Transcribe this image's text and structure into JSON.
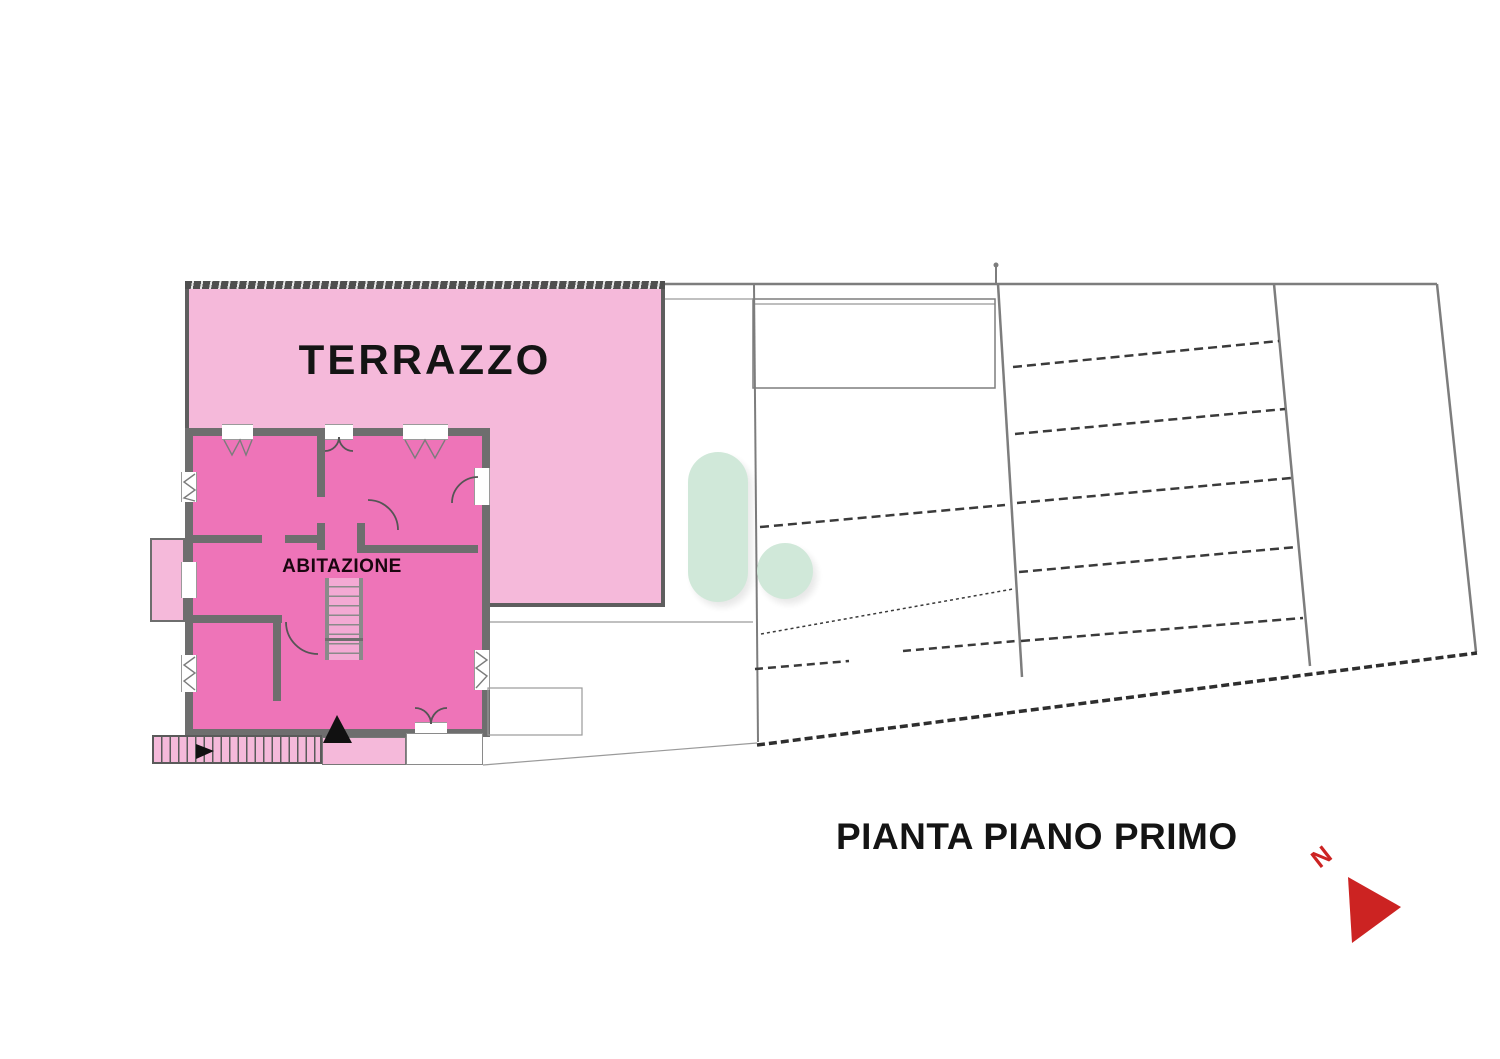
{
  "title": {
    "caption": "PIANTA PIANO PRIMO"
  },
  "plan": {
    "terrace_label": "TERRAZZO",
    "dwelling_label": "ABITAZIONE",
    "north_label": "N"
  },
  "colors": {
    "terrace_fill": "#f5b9da",
    "dwelling_fill": "#ee74b8",
    "wall_gray": "#6e6e6e",
    "line_gray": "#8f8f8f",
    "hatch_dark": "#3a3a3a",
    "north_red": "#cc2322",
    "watermark_green": "#cfe8d8",
    "text_black": "#141414"
  }
}
